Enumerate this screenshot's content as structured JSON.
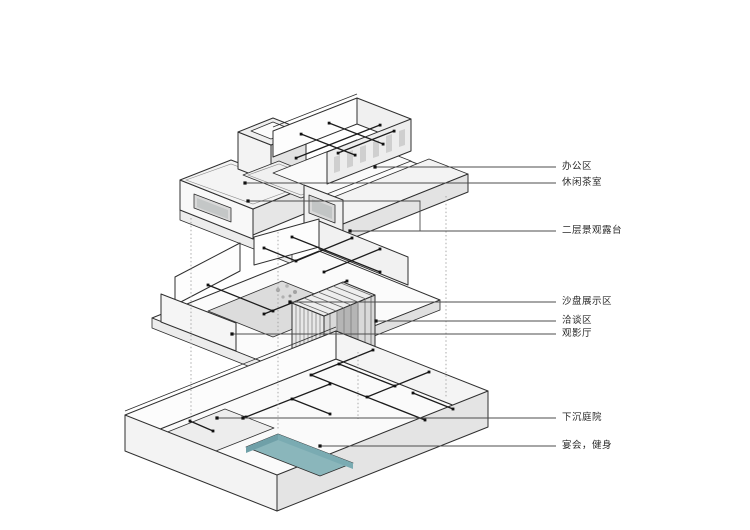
{
  "figure": {
    "kind": "exploded-axonometric-floor-diagram",
    "background": "#ffffff",
    "line_color": "#2f2f2f",
    "pool_color": "#8ab6bb"
  },
  "labels": [
    {
      "id": "office-area",
      "text": "办公区"
    },
    {
      "id": "leisure-tea-room",
      "text": "休闲茶室"
    },
    {
      "id": "second-floor-landscape-terrace",
      "text": "二层景观露台"
    },
    {
      "id": "sand-table-display-area",
      "text": "沙盘展示区"
    },
    {
      "id": "negotiation-area",
      "text": "洽谈区"
    },
    {
      "id": "screening-room",
      "text": "观影厅"
    },
    {
      "id": "sunken-courtyard",
      "text": "下沉庭院"
    },
    {
      "id": "banquet-fitness",
      "text": "宴会，健身"
    }
  ]
}
